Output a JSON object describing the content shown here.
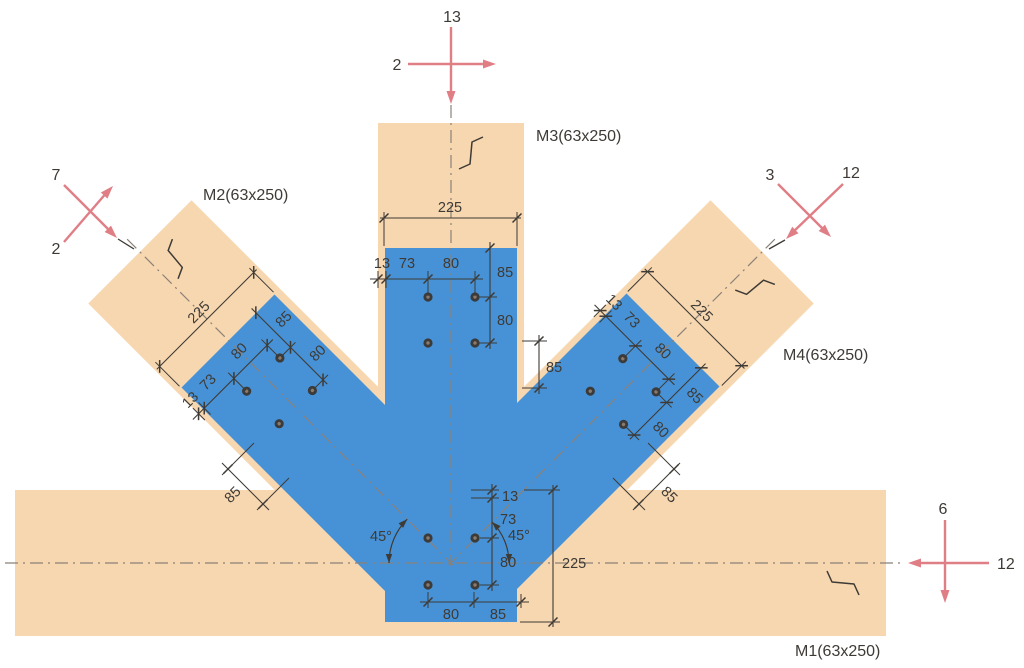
{
  "drawing_title": "timber-truss-joint-connection-detail",
  "members": {
    "m1": {
      "label": "M1(63x250)"
    },
    "m2": {
      "label": "M2(63x250)"
    },
    "m3": {
      "label": "M3(63x250)"
    },
    "m4": {
      "label": "M4(63x250)"
    }
  },
  "forces": {
    "top": {
      "vertical": "13",
      "horizontal": "2"
    },
    "top_left": {
      "upper": "7",
      "lower": "2"
    },
    "top_right": {
      "left": "3",
      "right": "12"
    },
    "right": {
      "vertical": "6",
      "horizontal": "12"
    }
  },
  "dims": {
    "plate_width": "225",
    "edge_offset": "13",
    "edge_to_bolt": "73",
    "bolt_spacing": "80",
    "end_distance": "85",
    "angle": "45°"
  },
  "colors": {
    "member_fill": "#F7D7B0",
    "plate_fill": "#4792D6",
    "force_arrow": "#E07E86",
    "dimension_ink": "#3E3A35",
    "centerline": "#8A8178",
    "bolt": "#3B3B3B"
  }
}
